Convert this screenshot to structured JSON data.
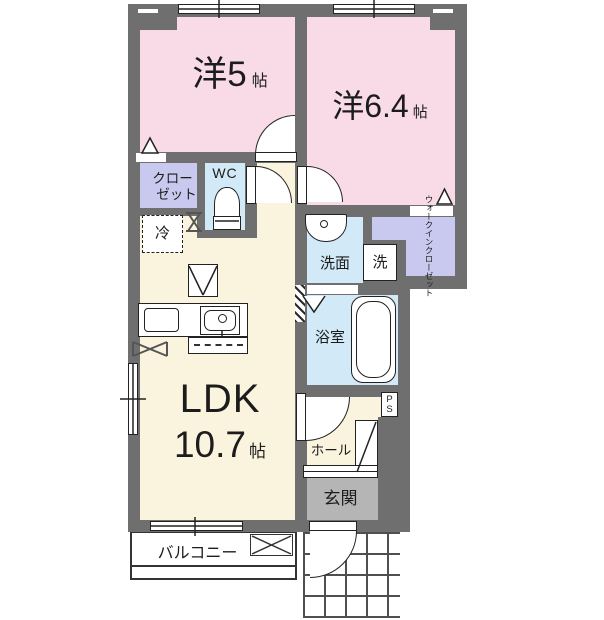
{
  "title": "apartment-floor-plan",
  "colors": {
    "wall": "#6f6f6f",
    "bedroom": "#f8dbe7",
    "closet": "#c9c9ef",
    "wet_area": "#d2eaf7",
    "living": "#faf3dd",
    "entrance": "#b5b5b5",
    "line": "#222222"
  },
  "rooms": {
    "bedroom5": {
      "label": "洋5",
      "unit": "帖"
    },
    "bedroom64": {
      "label": "洋6.4",
      "unit": "帖"
    },
    "ldk": {
      "label": "LDK",
      "size": "10.7",
      "unit": "帖"
    },
    "closet": {
      "line1": "クロー",
      "line2": "ゼット"
    },
    "wc": {
      "label": "WC"
    },
    "refrigerator": {
      "label": "冷"
    },
    "washroom": {
      "label": "洗面"
    },
    "washer": {
      "label": "洗"
    },
    "bathroom": {
      "label": "浴室"
    },
    "wic": {
      "line1": "ウォークイン",
      "line2": "クローゼット"
    },
    "hall": {
      "label": "ホール"
    },
    "entrance": {
      "label": "玄関"
    },
    "balcony": {
      "label": "バルコニー"
    },
    "ps": {
      "p": "P",
      "s": "S"
    }
  }
}
